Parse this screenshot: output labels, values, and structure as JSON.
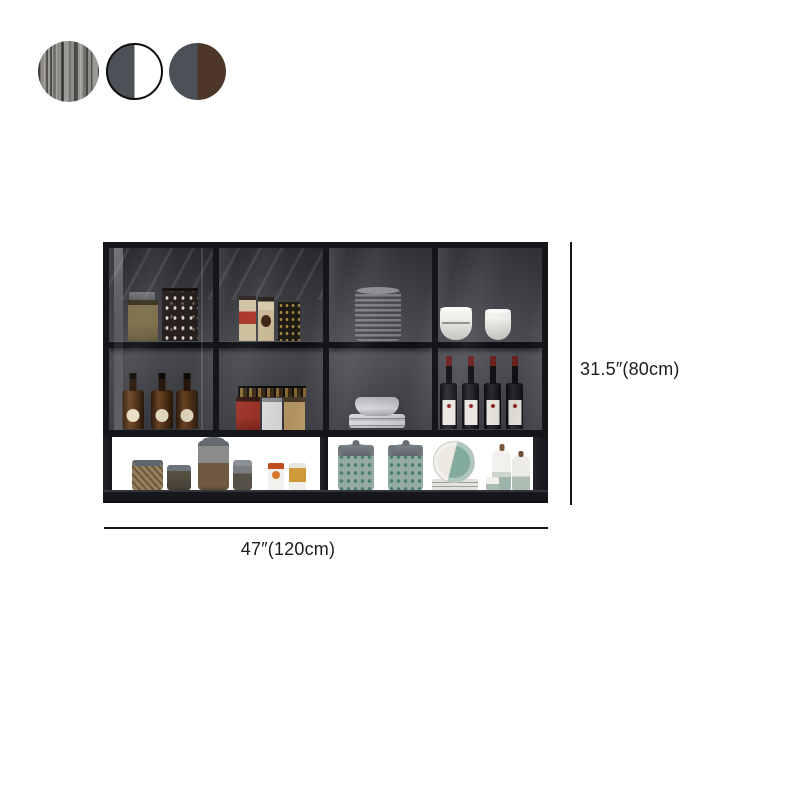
{
  "page": {
    "background": "#ffffff"
  },
  "swatches": {
    "items": [
      {
        "name": "grey-wood-grain",
        "type": "texture",
        "colors": [
          "#8f8d8a",
          "#55524e"
        ]
      },
      {
        "name": "grey-and-white",
        "type": "split",
        "left": "#4c5057",
        "right": "#ffffff",
        "border": "#0d0d0d"
      },
      {
        "name": "grey-and-brown",
        "type": "split",
        "left": "#4c5057",
        "right": "#4d372a"
      }
    ]
  },
  "dimensions": {
    "height_label": "31.5″(80cm)",
    "width_label": "47″(120cm)",
    "line_color": "#161616"
  },
  "cabinet": {
    "frame_color": "#15161a",
    "interior_color": "#4a4b50",
    "glass_sections": [
      {
        "name": "glass-door-1",
        "top_shelf": [
          "tan box",
          "dark patterned box",
          "shelf reflection"
        ],
        "bottom_shelf": [
          "three amber liquor bottles with round cream labels"
        ]
      },
      {
        "name": "glass-door-2",
        "top_shelf": [
          "two cream-and-red cartons",
          "dark gold-flecked carton"
        ],
        "bottom_shelf": [
          "row of small spice jars",
          "red box",
          "white box",
          "tan box"
        ]
      },
      {
        "name": "glass-door-3",
        "top_shelf": [
          "tall stack of grey plates"
        ],
        "bottom_shelf": [
          "stack of white plates with shallow bowl"
        ]
      },
      {
        "name": "glass-door-4",
        "top_shelf": [
          "two white bowls"
        ],
        "bottom_shelf": [
          "four wine bottles with white labels"
        ]
      }
    ],
    "open_shelf": {
      "left_bay": [
        "twine-filled jar",
        "small dark jar",
        "tall storage jar",
        "small glass jar",
        "orange-cap spice bottle",
        "amber spice bottle"
      ],
      "right_bay": [
        "two teal-speckled canisters with domed lids",
        "plate stack with leaning white-and-teal plate",
        "small shaker",
        "two white-and-teal ceramic bottles"
      ]
    }
  }
}
